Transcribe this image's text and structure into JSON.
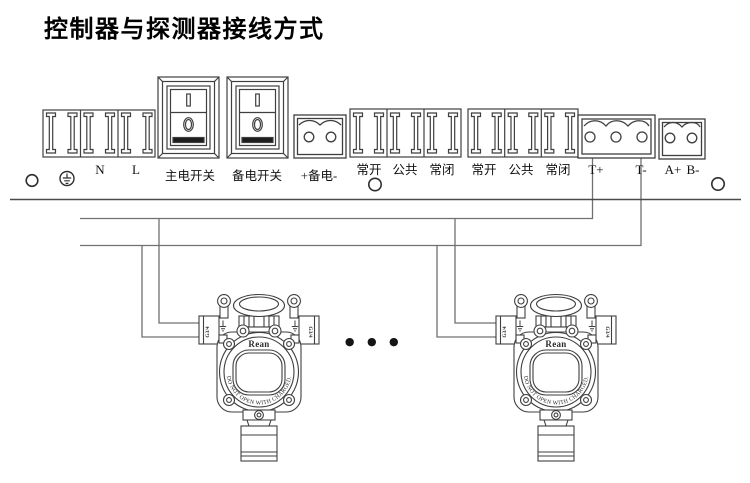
{
  "title": "控制器与探测器接线方式",
  "panel": {
    "power_block": {
      "neutral": "N",
      "live": "L"
    },
    "switches": {
      "main": "主电开关",
      "backup": "备电开关"
    },
    "backup_power_label": "+备电-",
    "relay1": [
      "常开",
      "公共",
      "常闭"
    ],
    "relay2": [
      "常开",
      "公共",
      "常闭"
    ],
    "signal": {
      "t_plus": "T+",
      "t_minus": "T-"
    },
    "bus": {
      "a_plus": "A+",
      "b_minus": "B-"
    }
  },
  "detector": {
    "logo": "Rean",
    "warning": "DO NOT OPEN WITH CHARGED.",
    "gland": "G3/4"
  },
  "ellipsis": "● ● ●",
  "colors": {
    "line": "#3f3f3f",
    "wire": "#707070",
    "text": "#111111"
  }
}
